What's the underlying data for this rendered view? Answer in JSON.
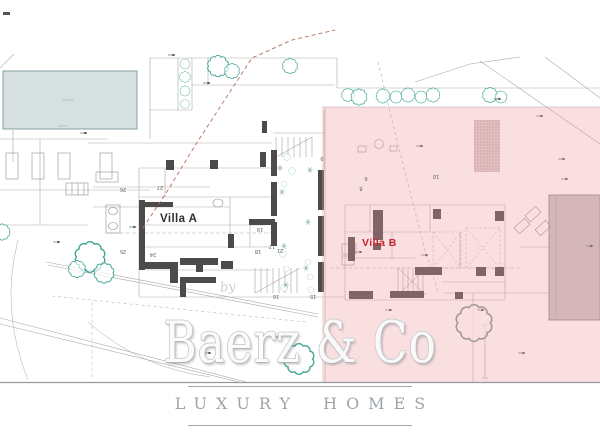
{
  "page": {
    "background": "#ffffff"
  },
  "plan": {
    "villa_a_label": "Villa A",
    "villa_b_label": "Villa B",
    "by_label": "by",
    "room_numbers": [
      "27",
      "26",
      "25",
      "24",
      "19",
      "18",
      "17",
      "16",
      "15",
      "21",
      "9",
      "10",
      "8",
      "6"
    ]
  },
  "watermark": {
    "brand": "Baerz & Co",
    "tagline": "LUXURY HOMES"
  },
  "colors": {
    "overlay_pink": "#ef9aa2",
    "tree_teal": "#3fa493",
    "wall_dark": "#4d4a4a",
    "pool_fill": "#d7e0e1",
    "pool_b_fill": "#c9c3c5",
    "villa_b_red": "#c4272e",
    "watermark_gray": "#939b9f",
    "red_dashed_line": "#b5705a"
  }
}
